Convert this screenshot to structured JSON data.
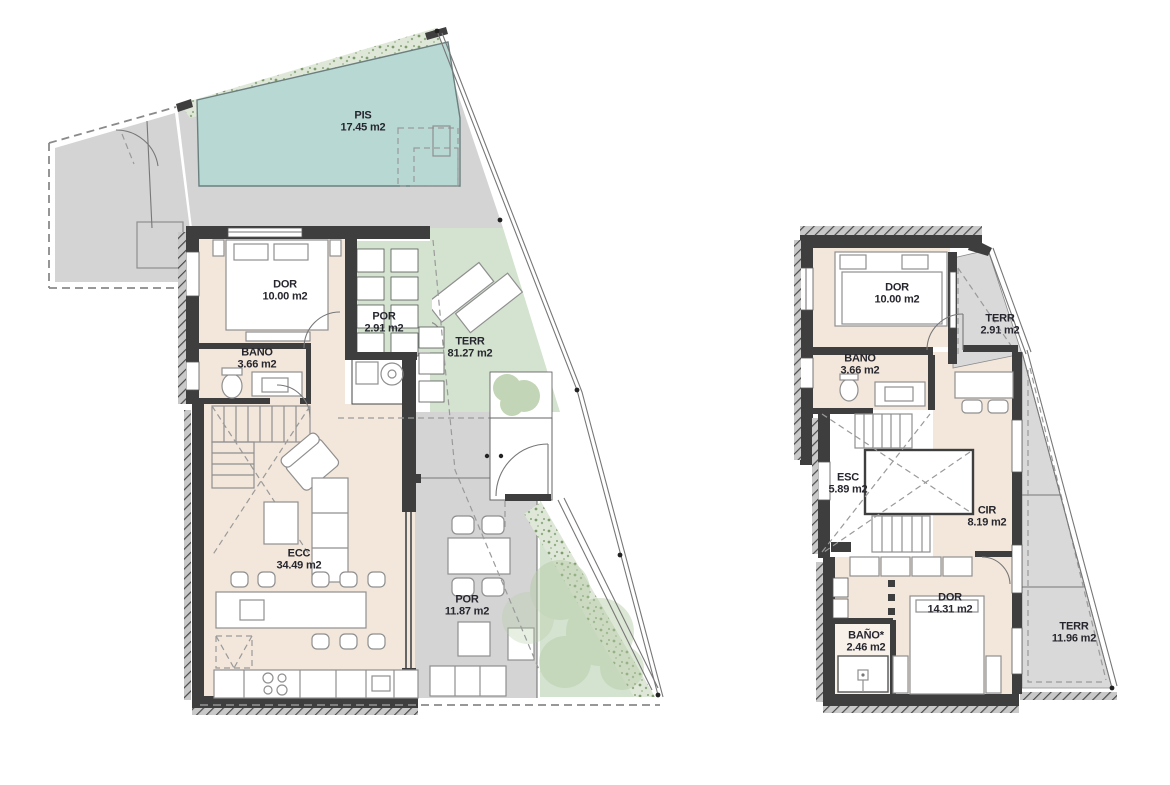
{
  "colors": {
    "wall": "#3e3e3e",
    "interior_beige": "#f3e7db",
    "pool_teal": "#b8d8d4",
    "terrace_green": "#d4e3d0",
    "paving_gray": "#d4d4d4",
    "terrace_gray": "#d9d9d9",
    "vegetation_green": "#8fae7e",
    "label_text": "#26262e"
  },
  "plans": {
    "left": {
      "rooms": [
        {
          "id": "pis",
          "label": "PIS",
          "area": "17.45 m2"
        },
        {
          "id": "dor",
          "label": "DOR",
          "area": "10.00 m2"
        },
        {
          "id": "por-small",
          "label": "POR",
          "area": "2.91 m2"
        },
        {
          "id": "terr",
          "label": "TERR",
          "area": "81.27 m2"
        },
        {
          "id": "bano",
          "label": "BANO",
          "area": "3.66 m2"
        },
        {
          "id": "ecc",
          "label": "ECC",
          "area": "34.49 m2"
        },
        {
          "id": "por",
          "label": "POR",
          "area": "11.87 m2"
        }
      ]
    },
    "right": {
      "rooms": [
        {
          "id": "dor-1",
          "label": "DOR",
          "area": "10.00 m2"
        },
        {
          "id": "terr-1",
          "label": "TERR",
          "area": "2.91 m2"
        },
        {
          "id": "bano-1",
          "label": "BANO",
          "area": "3.66 m2"
        },
        {
          "id": "esc",
          "label": "ESC",
          "area": "5.89 m2"
        },
        {
          "id": "cir",
          "label": "CIR",
          "area": "8.19 m2"
        },
        {
          "id": "dor-2",
          "label": "DOR",
          "area": "14.31 m2"
        },
        {
          "id": "bano-2",
          "label": "BAÑO*",
          "area": "2.46 m2"
        },
        {
          "id": "terr-2",
          "label": "TERR",
          "area": "11.96 m2"
        }
      ]
    }
  }
}
